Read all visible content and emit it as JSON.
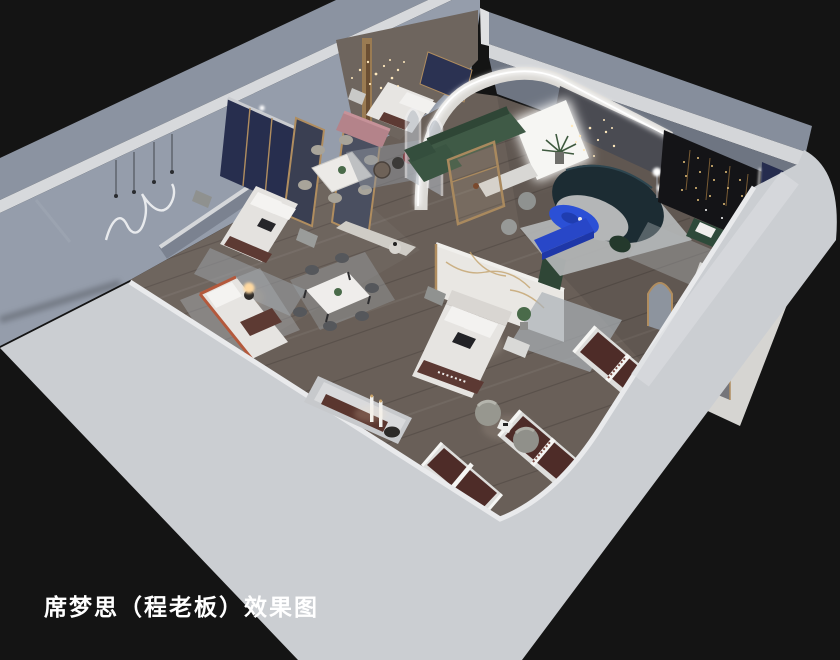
{
  "caption": {
    "text": "席梦思（程老板）效果图"
  },
  "colors": {
    "background": "#141414",
    "caption_text": "#ffffff",
    "exterior_wall_light": "#cbced2",
    "exterior_wall_shaded": "#8b93a1",
    "wall_top_edge": "#d7d9dc",
    "interior_wall": "#959dab",
    "floor_wood": "#695f58",
    "accent_navy": "#272e4e",
    "accent_green": "#3f5a46",
    "accent_teal_sofa": "#1c2c33",
    "accent_blue": "#2b50d6",
    "accent_pink": "#b4838a",
    "mattress_brown": "#4e2c28",
    "gold_trim": "#b08d5f",
    "led_white": "#ffffff"
  }
}
